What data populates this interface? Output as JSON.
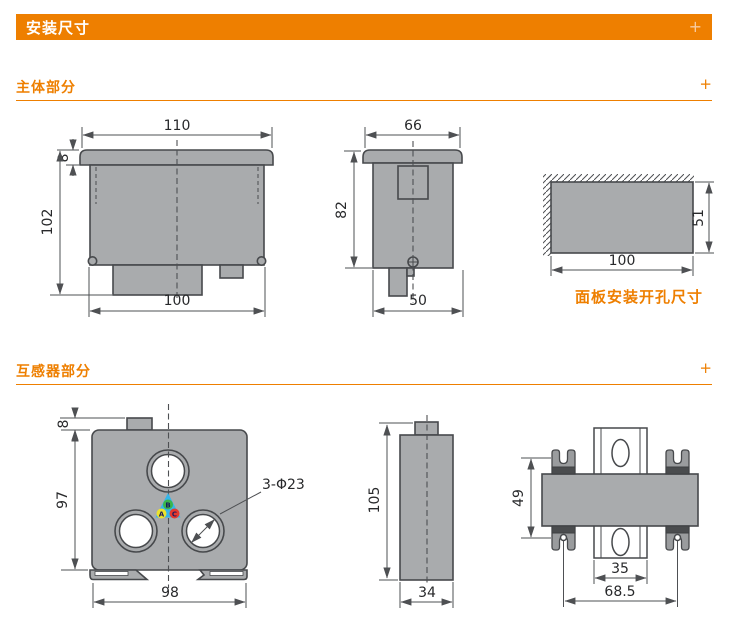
{
  "header": {
    "title": "安装尺寸",
    "expand_icon": "+"
  },
  "sections": {
    "main_body": {
      "title": "主体部分",
      "expand_icon": "+"
    },
    "transformer": {
      "title": "互感器部分",
      "expand_icon": "+"
    }
  },
  "main_body": {
    "front": {
      "top_width": "110",
      "bezel_height": "8",
      "height": "102",
      "bottom_width": "100"
    },
    "side": {
      "top_width": "66",
      "height": "82",
      "bottom_width": "50"
    },
    "cutout": {
      "width": "100",
      "height": "51",
      "caption": "面板安装开孔尺寸"
    }
  },
  "transformer": {
    "front": {
      "tab_height": "8",
      "height": "97",
      "width": "98",
      "holes_label": "3-Φ23",
      "phase_a": "A",
      "phase_b": "B",
      "phase_c": "C"
    },
    "side": {
      "height": "105",
      "width": "34"
    },
    "mount": {
      "clip_span": "49",
      "rail_width": "35",
      "hole_spacing": "68.5"
    }
  },
  "colors": {
    "accent": "#EE7F00",
    "part_fill": "#A9ABAD",
    "outline": "#47494C",
    "clip_dark": "#4A4C4E"
  }
}
